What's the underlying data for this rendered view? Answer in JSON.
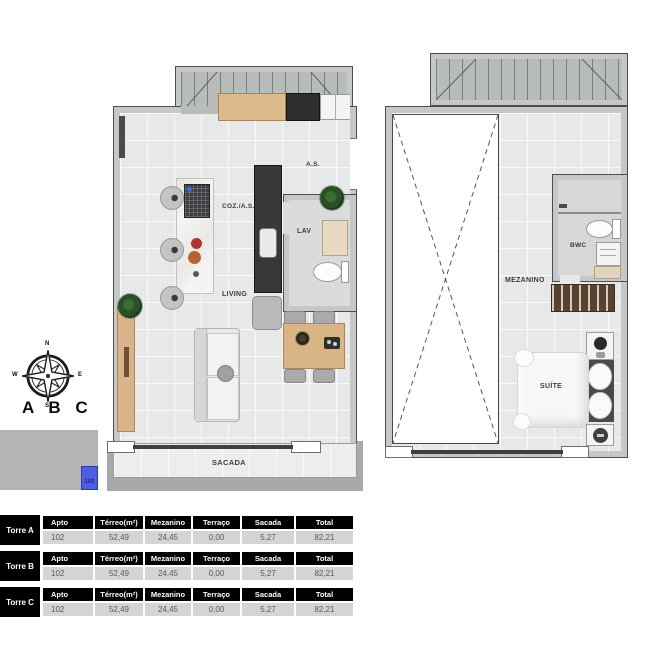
{
  "terreo_plan": {
    "labels": {
      "as": "A.S.",
      "coz_as": "COZ./A.S.",
      "lav": "LAV",
      "living": "LIVING",
      "sacada": "SACADA"
    }
  },
  "mezanino_plan": {
    "labels": {
      "bwc": "BWC",
      "mezanino": "MEZANINO",
      "suite": "SUÍTE"
    }
  },
  "keyplan": {
    "compass": {
      "n": "N",
      "e": "E",
      "s": "S",
      "w": "W"
    },
    "building_label": "A B C",
    "unit_number": "102",
    "highlight_color": "#4d5fe0"
  },
  "tables": [
    {
      "tower": "Torre A",
      "headers": [
        "Apto",
        "Térreo(m²)",
        "Mezanino",
        "Terraço",
        "Sacada",
        "Total"
      ],
      "values": [
        "102",
        "52,49",
        "24,45",
        "0,00",
        "5,27",
        "82,21"
      ]
    },
    {
      "tower": "Torre B",
      "headers": [
        "Apto",
        "Térreo(m²)",
        "Mezanino",
        "Terraço",
        "Sacada",
        "Total"
      ],
      "values": [
        "102",
        "52,49",
        "24,45",
        "0,00",
        "5,27",
        "82,21"
      ]
    },
    {
      "tower": "Torre C",
      "headers": [
        "Apto",
        "Térreo(m²)",
        "Mezanino",
        "Terraço",
        "Sacada",
        "Total"
      ],
      "values": [
        "102",
        "52,49",
        "24,45",
        "0,00",
        "5,27",
        "82,21"
      ]
    }
  ]
}
